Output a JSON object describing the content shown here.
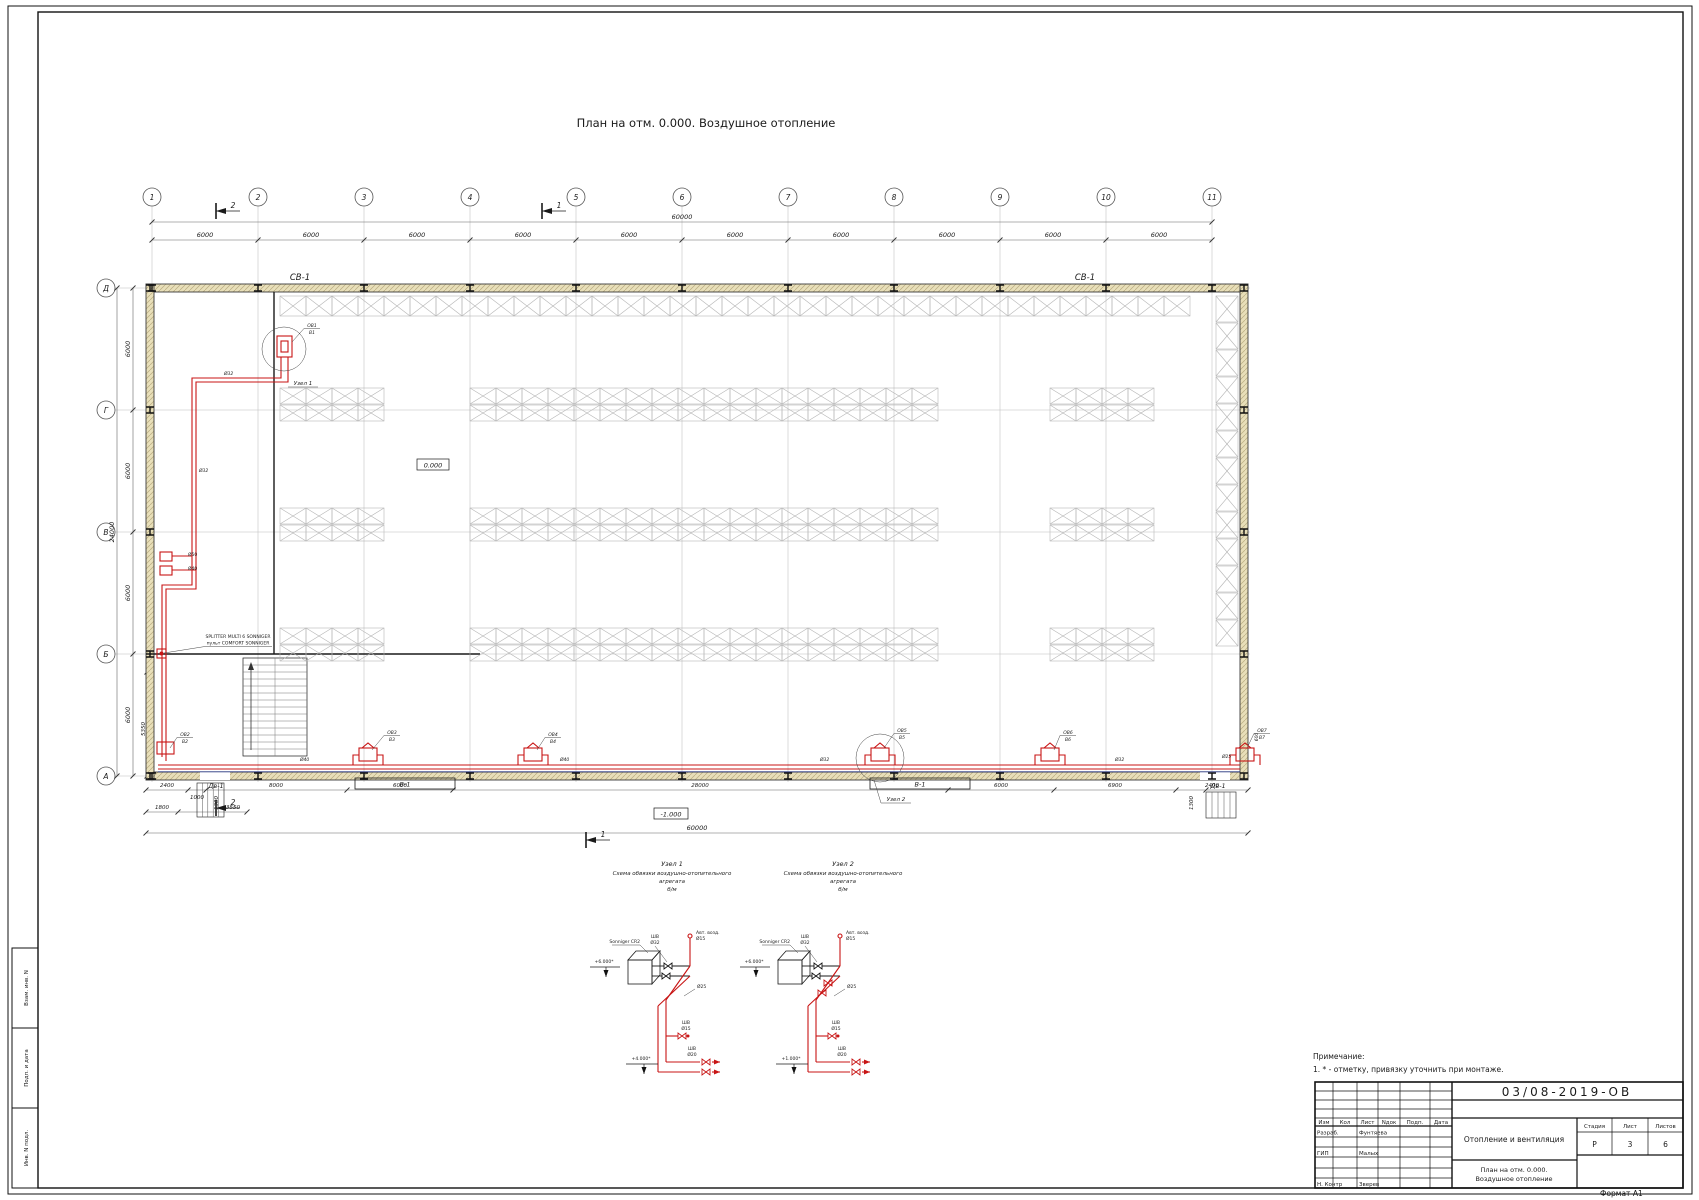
{
  "sheet": {
    "title": "План на отм. 0.000. Воздушное отопление",
    "format": "Формат А1",
    "stamp_labels": [
      "Взам. инв. N",
      "Подп. и дата",
      "Инв. N подл."
    ]
  },
  "notes": {
    "header": "Примечание:",
    "item1": "1. * - отметку, привязку уточнить при монтаже."
  },
  "plan": {
    "grid_cols": [
      "1",
      "2",
      "3",
      "4",
      "5",
      "6",
      "7",
      "8",
      "9",
      "10",
      "11"
    ],
    "grid_rows": [
      "Д",
      "Г",
      "В",
      "Б",
      "А"
    ],
    "bay_dims": [
      "6000",
      "6000",
      "6000",
      "6000",
      "6000",
      "6000",
      "6000",
      "6000",
      "6000",
      "6000"
    ],
    "top_total": "60000",
    "left_dims": [
      "6000",
      "6000",
      "6000",
      "6000"
    ],
    "left_total": "24000",
    "left_extra": "5350",
    "bottom_total": "60000",
    "bottom_dims": [
      "2400",
      "1000",
      "1300",
      "8000",
      "6000",
      "28000",
      "6000",
      "6900",
      "1300",
      "2400"
    ],
    "bottom_dims2": [
      "1800",
      "3550"
    ],
    "right_dim": "600",
    "beam_label_1": "СВ-1",
    "beam_label_2": "СВ-1",
    "elev_zero": "0.000",
    "elev_basement": "-1.000",
    "door_label_1": "Дв-1",
    "door_label_2": "Дв-1",
    "gate_label_1": "В-1",
    "gate_label_2": "В-1",
    "section_1": "1",
    "section_2": "2",
    "node_flag_1": "Узел 1",
    "node_flag_2": "Узел 2",
    "splitter_line1": "SPLITTER MULTI 6 SONNIGER",
    "splitter_line2": "пульт COMFORT SONNIGER",
    "pump_dn1": "Ø50",
    "pump_dn2": "Ø40",
    "pipe_dn_riser": "Ø32",
    "pipe_dn_vert": "Ø32",
    "pipe_dn_1": "Ø40",
    "pipe_dn_2": "Ø40",
    "pipe_dn_3": "Ø32",
    "pipe_dn_4": "Ø32",
    "pipe_dn_5": "Ø25",
    "unit_tags": [
      [
        "ОВ1",
        "В1"
      ],
      [
        "ОВ2",
        "В2"
      ],
      [
        "ОВ3",
        "В3"
      ],
      [
        "ОВ4",
        "В4"
      ],
      [
        "ОВ5",
        "В5"
      ],
      [
        "ОВ6",
        "В6"
      ],
      [
        "ОВ7",
        "В7"
      ]
    ]
  },
  "details": {
    "d1": {
      "title": "Узел 1",
      "sub1": "Схема обвязки воздушно-отопительного",
      "sub2": "агрегата",
      "scale": "б/м",
      "box": "Sonniger CR2",
      "valve1": "ШВ",
      "valve2": "Ø32",
      "vent1": "Авт. возд.",
      "vent2": "Ø15",
      "drain1": "ШВ",
      "drain2": "Ø15",
      "bvalve1": "ШВ",
      "bvalve2": "Ø20",
      "branch": "Ø25",
      "elev_top": "+6.000*",
      "elev_bottom": "+4.000*"
    },
    "d2": {
      "title": "Узел 2",
      "sub1": "Схема обвязки воздушно-отопительного",
      "sub2": "агрегата",
      "scale": "б/м",
      "box": "Sonniger CR2",
      "valve1": "ШВ",
      "valve2": "Ø32",
      "vent1": "Авт. возд.",
      "vent2": "Ø15",
      "drain1": "ШВ",
      "drain2": "Ø15",
      "bvalve1": "ШВ",
      "bvalve2": "Ø20",
      "branch": "Ø25",
      "elev_top": "+6.000*",
      "elev_bottom": "+1.000*"
    }
  },
  "title_block": {
    "doc_number": "03/08-2019-ОВ",
    "cols": [
      "Изм",
      "Кол",
      "Лист",
      "Nдок",
      "Подп.",
      "Дата"
    ],
    "role_1": "Разраб.",
    "name_1": "Фунтяева",
    "role_2": "ГИП",
    "name_2": "Малых",
    "role_3": "Н. Контр",
    "name_3": "Зверев",
    "project": "Отопление и вентиляция",
    "stage_h": "Стадия",
    "sheet_h": "Лист",
    "sheets_h": "Листов",
    "stage": "Р",
    "sheet": "3",
    "sheets": "6",
    "title_line1": "План на отм. 0.000.",
    "title_line2": "Воздушное отопление"
  }
}
